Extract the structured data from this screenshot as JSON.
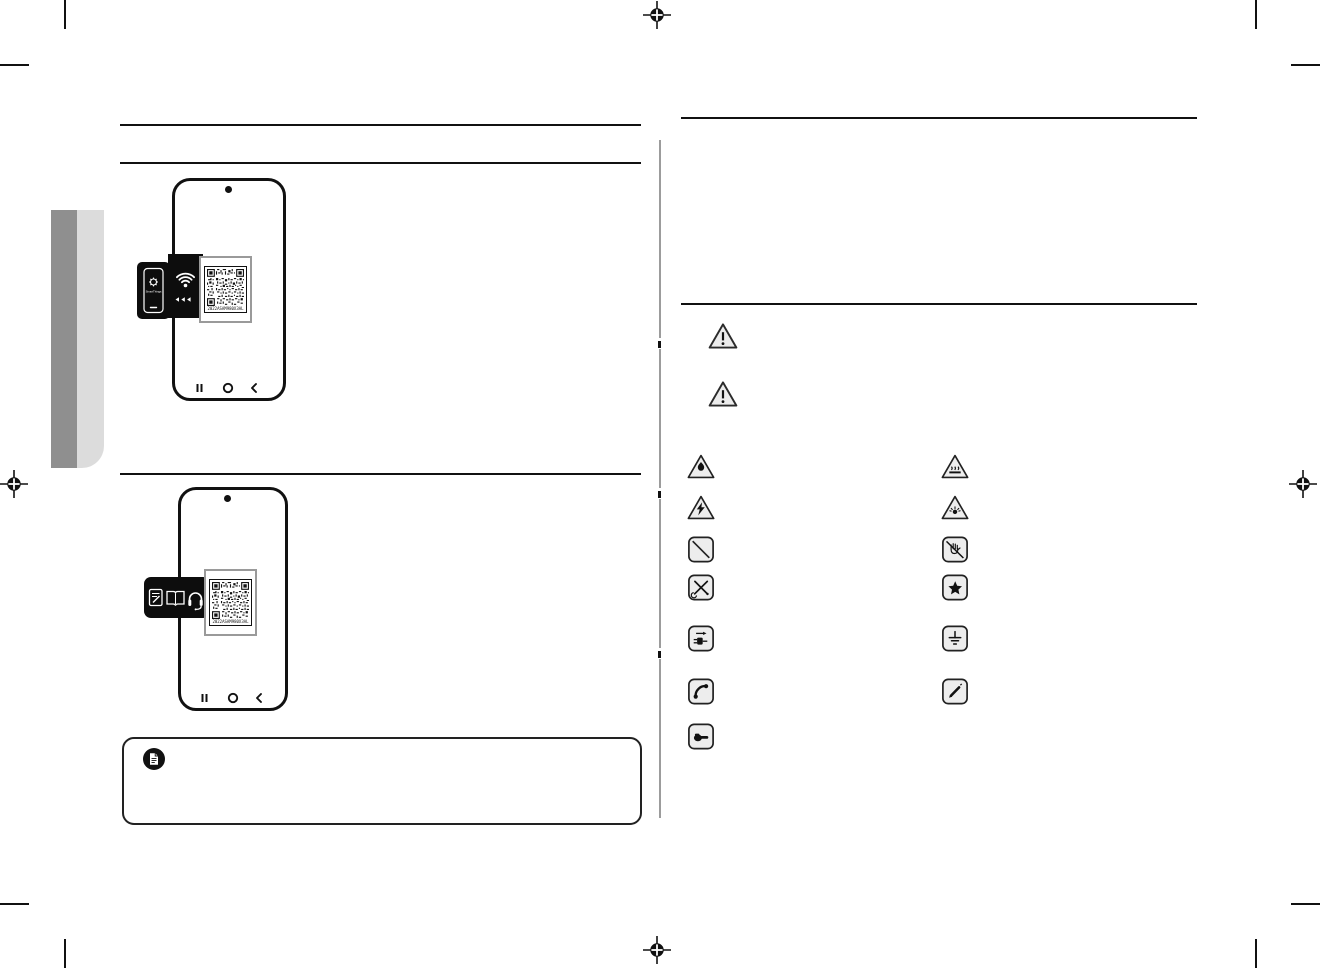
{
  "page": {
    "width": 1320,
    "height": 968,
    "background": "#ffffff"
  },
  "print_marks": {
    "registration_positions": [
      "top-center",
      "left-center",
      "right-center",
      "bottom-center"
    ],
    "crop_corners": [
      "top-left",
      "top-right",
      "bottom-left",
      "bottom-right"
    ]
  },
  "chapter_tab": {
    "dark_color": "#8f8f8f",
    "light_color": "#dcdcdc"
  },
  "left_column": {
    "phone1": {
      "app_label": "SmartThings",
      "qr_serial": "2022ASAM980X3AL",
      "icons": [
        "smartthings-gear-icon",
        "wifi-icon",
        "back-arrows-icon",
        "qr-code"
      ]
    },
    "phone2": {
      "qr_serial": "2022ASAM980X3AL",
      "icons": [
        "warranty-card-icon",
        "user-manual-icon",
        "support-headset-icon",
        "qr-code"
      ]
    },
    "note": {
      "icon": "note-document-icon",
      "text": ""
    }
  },
  "right_column": {
    "divider_color": "#9c9c9c",
    "warning_markers": [
      {
        "name": "warning-triangle"
      },
      {
        "name": "caution-triangle"
      }
    ],
    "symbol_fill": "#ededed",
    "symbol_stroke": "#222222",
    "safety_symbols": [
      {
        "name": "flame-hazard-icon",
        "glyph": "flame",
        "col": 0,
        "row": 0
      },
      {
        "name": "hot-surface-icon",
        "glyph": "hot",
        "col": 1,
        "row": 0
      },
      {
        "name": "electric-shock-icon",
        "glyph": "shock",
        "col": 0,
        "row": 1
      },
      {
        "name": "explosion-hazard-icon",
        "glyph": "explosion",
        "col": 1,
        "row": 1
      },
      {
        "name": "prohibited-icon",
        "glyph": "prohibit",
        "col": 0,
        "row": 2
      },
      {
        "name": "do-not-touch-icon",
        "glyph": "notouch",
        "col": 1,
        "row": 2
      },
      {
        "name": "do-not-disassemble-icon",
        "glyph": "notools",
        "col": 0,
        "row": 3
      },
      {
        "name": "follow-instructions-icon",
        "glyph": "star",
        "col": 1,
        "row": 3
      },
      {
        "name": "unplug-icon",
        "glyph": "unplug",
        "col": 0,
        "row": 4
      },
      {
        "name": "ground-icon",
        "glyph": "ground",
        "col": 1,
        "row": 4
      },
      {
        "name": "call-service-icon",
        "glyph": "phone",
        "col": 0,
        "row": 5
      },
      {
        "name": "note-pencil-icon",
        "glyph": "pencil",
        "col": 1,
        "row": 5
      },
      {
        "name": "hand-point-icon",
        "glyph": "handpoint",
        "col": 0,
        "row": 6
      }
    ]
  }
}
